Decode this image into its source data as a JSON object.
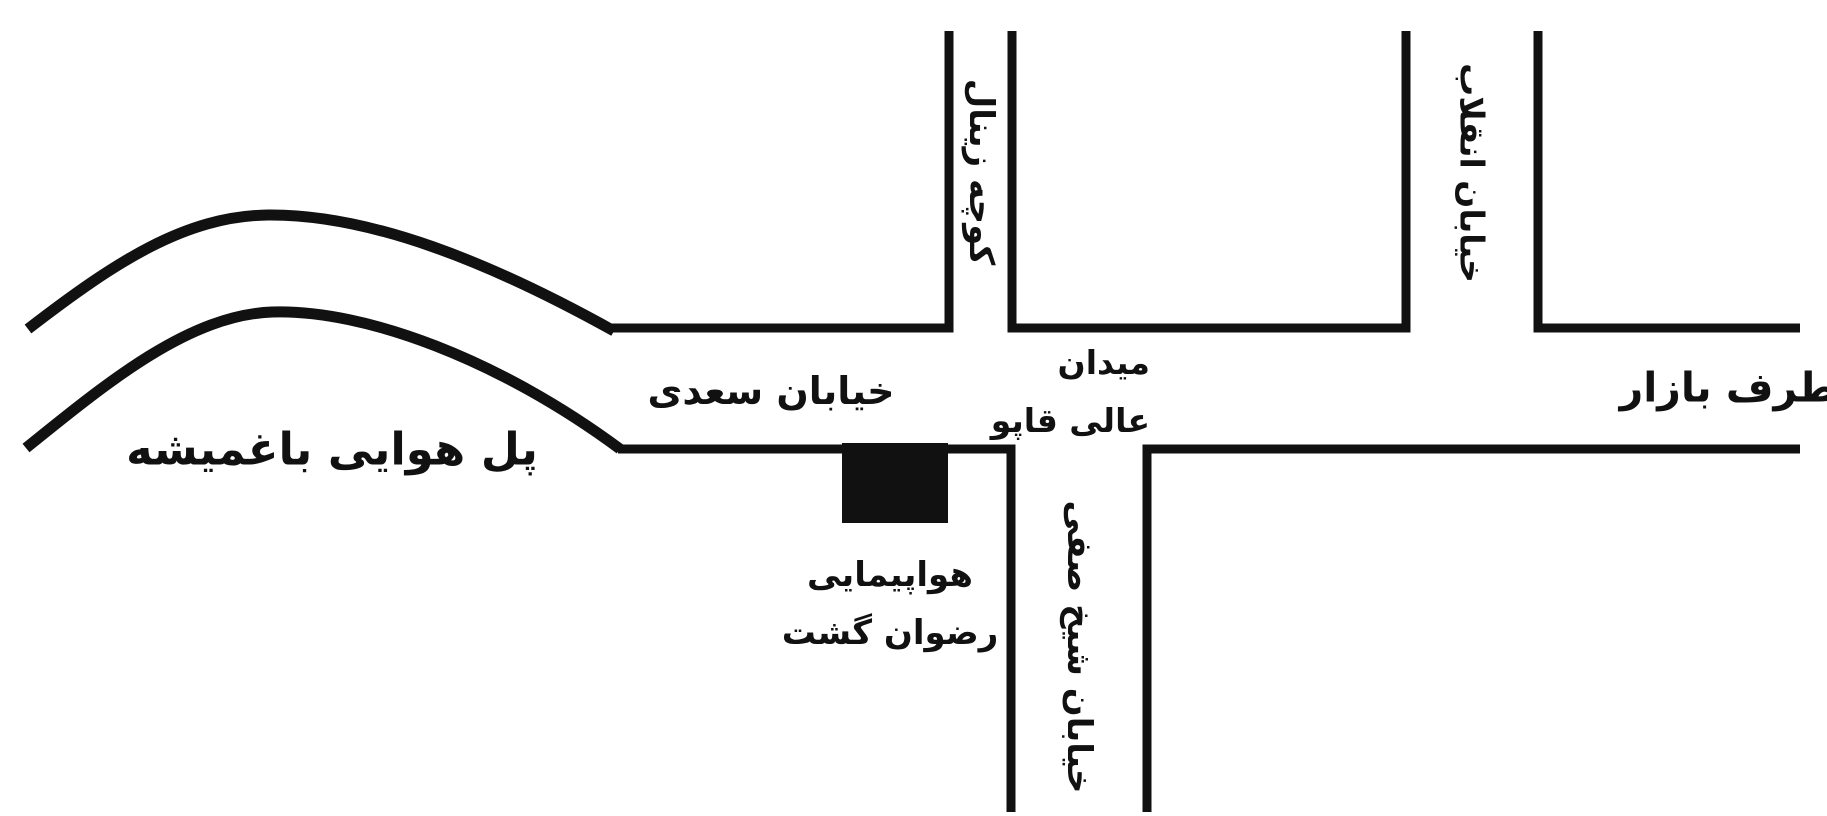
{
  "colors": {
    "background": "#ffffff",
    "ink": "#111111"
  },
  "map": {
    "bridge_label": "پل هوایی باغمیشه",
    "saadi_street_label": "خیابان سعدی",
    "square_label_line1": "میدان",
    "square_label_line2": "عالی قاپو",
    "to_bazaar_label": "بطرف بازار",
    "zeynal_alley_label": "کوچه زینال",
    "enghelab_street_label": "خیابان انقلاب",
    "sheikh_safi_street_label": "خیابان شیخ صفی",
    "agency_label_line1": "هواپیمایی",
    "agency_label_line2": "رضوان گشت"
  }
}
